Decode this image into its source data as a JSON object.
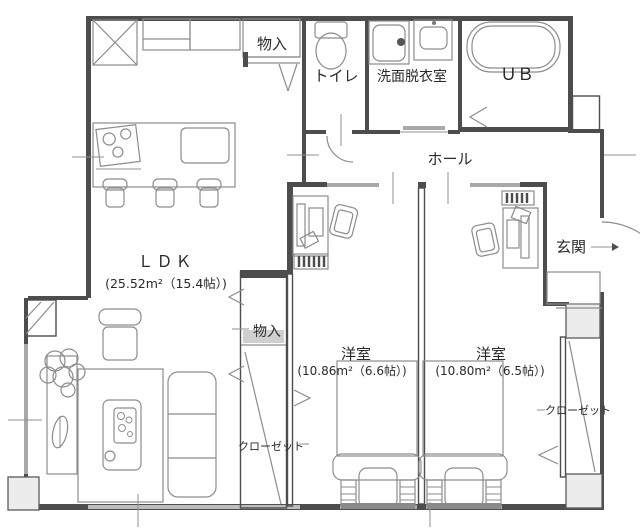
{
  "colors": {
    "wall": "#4d4d4d",
    "line": "#8c8c8c",
    "window": "#a8a8a8",
    "text": "#2a2a2a",
    "bg": "#ffffff"
  },
  "rooms": {
    "ldk": {
      "label": "ＬＤＫ",
      "area": "(25.52m²（15.4帖）)"
    },
    "bedroom1": {
      "label": "洋室",
      "area": "(10.86m²（6.6帖）)"
    },
    "bedroom2": {
      "label": "洋室",
      "area": "(10.80m²（6.5帖）)"
    },
    "toilet": {
      "label": "トイレ"
    },
    "washroom": {
      "label": "洗面脱衣室"
    },
    "bath": {
      "label": "ＵＢ"
    },
    "hall": {
      "label": "ホール"
    },
    "entrance": {
      "label": "玄関"
    },
    "storage_top": {
      "label": "物入"
    },
    "storage_mid": {
      "label": "物入"
    },
    "closet_left": {
      "label": "クローゼット"
    },
    "closet_right": {
      "label": "クローゼット"
    }
  }
}
